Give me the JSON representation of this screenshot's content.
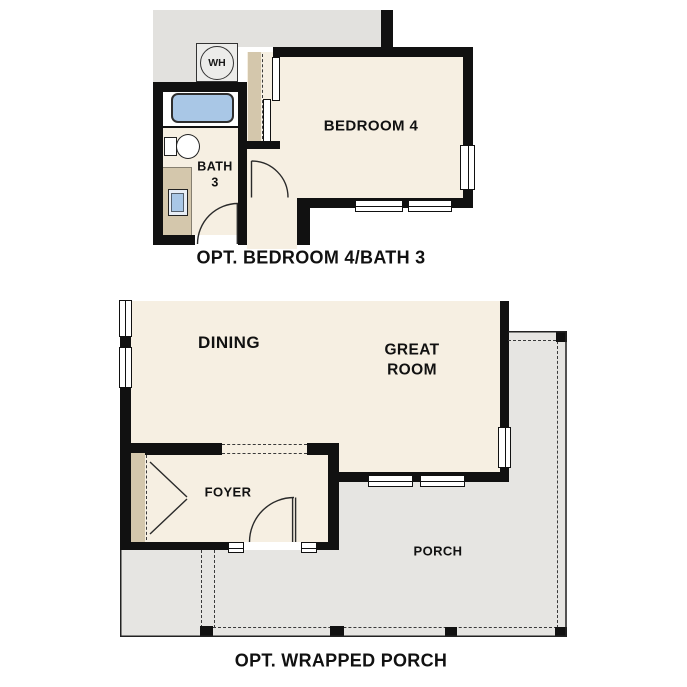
{
  "colors": {
    "floor_beige": "#f6efe2",
    "existing_gray": "#e2e1de",
    "porch_gray": "#e6e5e2",
    "tan": "#d4c7ac",
    "fixture_blue": "#a9c7e6",
    "wall_black": "#111111",
    "text_ink": "#1a1a1a"
  },
  "plan_top": {
    "caption": "OPT. BEDROOM 4/BATH 3",
    "rooms": {
      "bedroom4": "BEDROOM 4",
      "bath_line1": "BATH",
      "bath_line2": "3"
    },
    "fixtures": {
      "water_heater": "WH"
    }
  },
  "plan_bottom": {
    "caption": "OPT. WRAPPED PORCH",
    "rooms": {
      "dining": "DINING",
      "great_room_line1": "GREAT",
      "great_room_line2": "ROOM",
      "foyer": "FOYER",
      "porch": "PORCH"
    }
  }
}
